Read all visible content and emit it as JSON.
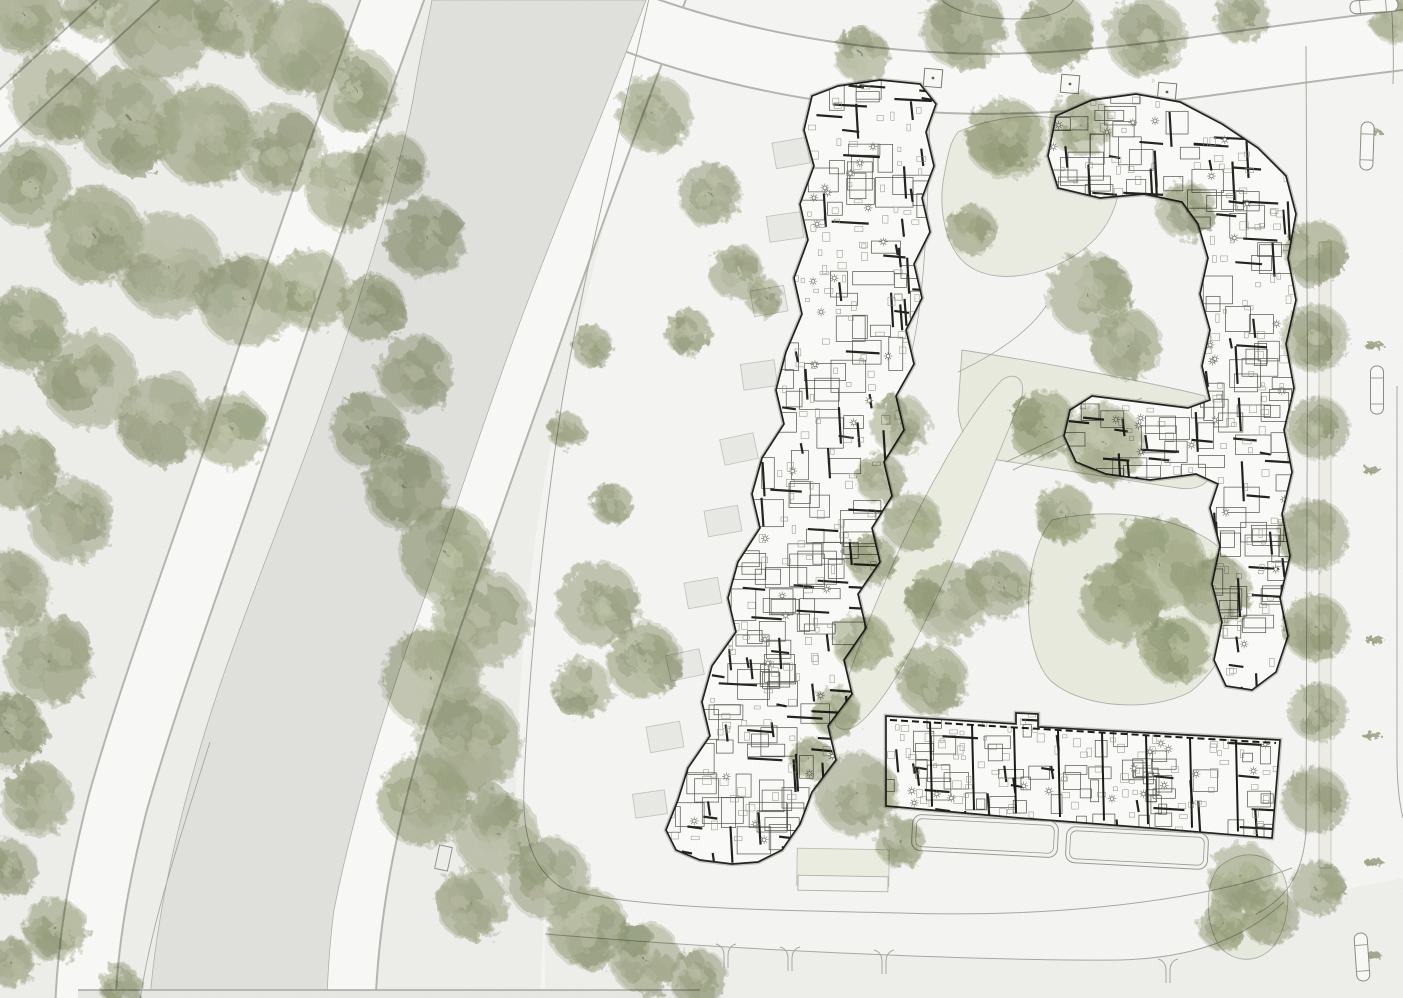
{
  "meta": {
    "title": "Residential quarter site plan with canal and woodland",
    "width": 1403,
    "height": 998,
    "drawing_type": "architectural site plan",
    "visible_text": ""
  },
  "palette": {
    "bg": "#f7f7f5",
    "park": "#f0f0ec",
    "canal": "#e2e3df",
    "band_edge": "#b6b6b0",
    "band_fill": "#fbfbf9",
    "line": "#a8a8a2",
    "line_dark": "#77776f",
    "lawn_stroke": "#b2b2aa",
    "building_fill": "#fdfdfb",
    "building_halo": "#97978f",
    "wall": "#1d1d1a",
    "room": "#4f4f49",
    "furniture": "#8f8f86",
    "terrace_fill": "#ebebe7",
    "terrace_stroke": "#c6c6c0",
    "sidewalk": "#f0efe8",
    "green_base": [
      "#aab08f",
      "#9ca580",
      "#b6bca0",
      "#a3a98a"
    ],
    "green_dark": "#8f9875",
    "green_light": "#c3c8ad",
    "bottom_strip": "#f1f1ee",
    "car_fill": "#fbfbf9",
    "car_stroke": "#8a8a84"
  },
  "ground": {
    "park_poly": "M0,0 L660,0 C625,150 585,295 552,440 C528,560 518,690 516,790 C515,845 525,872 545,890 L540,998 L0,998 Z",
    "canal_poly": "M432,0 L646,0 C602,118 560,214 520,322 C480,430 452,520 416,622 C380,724 352,820 334,910 C330,940 328,970 327,998 L150,998 C158,905 180,812 208,722 C240,620 286,512 322,408 C358,306 402,168 415,88 C420,56 428,22 432,0 Z",
    "bottom_strip_poly": "M545,934 C760,952 1000,961 1120,960 C1192,958 1242,940 1284,902 L1403,878 L1403,998 L545,998 Z",
    "bottom_edge_rect": {
      "x": 78,
      "y": 990,
      "w": 622,
      "h": 8
    }
  },
  "bands": [
    {
      "name": "corner-road-northwest",
      "d": "M-24,140 L154,-24",
      "w": 44
    },
    {
      "name": "towpath-west",
      "d": "M398,-16 C348,122 298,264 252,402 C206,540 152,682 118,802 C96,888 87,952 85,1012",
      "w": 62
    },
    {
      "name": "towpath-east",
      "d": "M664,-16 C612,122 566,246 522,374 C482,484 448,584 410,694 C374,802 353,902 349,1012",
      "w": 54
    },
    {
      "name": "north-loop-road",
      "d": "M516,-32 C620,28 762,72 930,82 C1082,92 1222,60 1420,38",
      "w": 62
    }
  ],
  "lawns": [
    {
      "name": "courtyard-green-north",
      "d": "M958,132 C1008,110 1076,110 1108,140 C1128,164 1122,210 1096,238 C1066,270 1006,288 972,268 C944,252 938,206 944,176 C948,154 950,142 958,132 Z",
      "fill": "#edeee4"
    },
    {
      "name": "courtyard-wedge",
      "d": "M962,350 C1040,362 1150,382 1205,396 L1212,468 C1212,484 1196,491 1178,488 L998,460 C972,455 960,436 958,410 Z",
      "fill": "#eaede0"
    },
    {
      "name": "courtyard-green-south",
      "d": "M1052,520 C1120,504 1200,520 1232,560 C1250,600 1230,662 1190,692 C1150,713 1080,708 1050,680 C1022,650 1020,560 1052,520 Z",
      "fill": "#eaede0"
    },
    {
      "name": "swale-garden",
      "d": "M836,716 C858,640 900,540 940,470 C960,432 986,396 1002,380 C1016,370 1027,381 1021,399 C996,460 956,560 916,640 C896,682 868,721 852,728 C840,732 832,726 836,716 Z",
      "fill": "#ecefe2"
    },
    {
      "name": "traffic-island-green",
      "d": "M1218,868 C1240,848 1268,852 1282,872 C1293,893 1288,928 1272,948 C1256,965 1230,962 1218,944 C1206,922 1204,888 1218,868 Z",
      "fill": "#e9ece0"
    }
  ],
  "lawn_panel": {
    "x": 797,
    "y": 849,
    "w": 92,
    "h": 37,
    "rot": 1,
    "fill": "#eef0e3",
    "stroke": "#bdbdb5"
  },
  "paths": [
    {
      "name": "site-boundary",
      "d": "M650,-6 C622,120 586,262 562,402 C544,520 530,652 524,782 C522,832 530,868 562,888 C624,908 760,910 900,913 C1050,918 1200,902 1292,868",
      "w": 1
    },
    {
      "name": "curb-south",
      "d": "M545,934 C760,952 1000,961 1120,960 C1192,958 1242,940 1284,902",
      "w": 1
    },
    {
      "name": "curve-northeast",
      "d": "M940,-2 C952,14 1000,23 1040,17 C1062,13 1072,5 1074,-2",
      "w": 1
    },
    {
      "name": "curb-east-road",
      "d": "M1306,46 C1308,300 1308,600 1306,832 C1303,872 1288,898 1256,914",
      "w": 1
    },
    {
      "name": "curb-far-right-top",
      "d": "M1391,-2 C1393,28 1394,56 1393,84",
      "w": 1
    },
    {
      "name": "curb-far-right",
      "d": "M1397,386 L1397,756 C1397,788 1400,806 1403,818",
      "w": 1
    },
    {
      "name": "bank-line-southwest",
      "d": "M210,742 C180,838 152,920 140,1000",
      "w": 0.9
    },
    {
      "name": "court-path-a",
      "d": "M906,372 C920,330 928,260 930,96",
      "w": 0.8
    },
    {
      "name": "court-path-b",
      "d": "M958,372 C1000,352 1030,330 1046,306",
      "w": 0.8
    },
    {
      "name": "court-path-c",
      "d": "M1215,476 C1243,486 1260,498 1270,514",
      "w": 0.8
    },
    {
      "name": "ramp-line-1",
      "d": "M1006,462 L1142,398",
      "w": 1
    },
    {
      "name": "ramp-line-2",
      "d": "M1013,470 L1148,404",
      "w": 1
    },
    {
      "name": "bottom-edge-line",
      "d": "M78,990 L700,990",
      "w": 1.4
    }
  ],
  "sidewalk_band": {
    "x": 1319,
    "y": 242,
    "w": 12,
    "h": 626
  },
  "curb_cuts": [
    [
      726,
      944
    ],
    [
      790,
      947
    ],
    [
      884,
      950
    ],
    [
      1168,
      959
    ]
  ],
  "planters": [
    [
      933,
      78
    ],
    [
      1070,
      84
    ],
    [
      1167,
      92
    ]
  ],
  "misc_rects": [
    {
      "name": "canal-jetty",
      "x": 437,
      "y": 846,
      "w": 13,
      "h": 24,
      "rot": 12,
      "fill": "none",
      "stroke": "#8a8a85"
    },
    {
      "name": "parking-pad",
      "x": 798,
      "y": 876,
      "w": 90,
      "h": 15,
      "rot": 1,
      "fill": "#f6f6f2",
      "stroke": "#b0b0aa"
    }
  ],
  "terraces_building_a": [
    {
      "x": 774,
      "y": 140,
      "w": 34,
      "h": 26,
      "rot": -10
    },
    {
      "x": 768,
      "y": 214,
      "w": 34,
      "h": 26,
      "rot": -8
    },
    {
      "x": 752,
      "y": 288,
      "w": 34,
      "h": 26,
      "rot": -10
    },
    {
      "x": 742,
      "y": 362,
      "w": 34,
      "h": 26,
      "rot": -8
    },
    {
      "x": 722,
      "y": 436,
      "w": 34,
      "h": 26,
      "rot": -12
    },
    {
      "x": 706,
      "y": 508,
      "w": 34,
      "h": 26,
      "rot": -10
    },
    {
      "x": 686,
      "y": 580,
      "w": 34,
      "h": 26,
      "rot": -10
    },
    {
      "x": 668,
      "y": 652,
      "w": 34,
      "h": 26,
      "rot": -12
    },
    {
      "x": 648,
      "y": 724,
      "w": 34,
      "h": 26,
      "rot": -10
    },
    {
      "x": 634,
      "y": 792,
      "w": 32,
      "h": 24,
      "rot": -8
    }
  ],
  "buildings": [
    {
      "id": "A",
      "name": "apartment-slab-central",
      "seed": 11,
      "rooms": 110,
      "walls": 84,
      "furn": 150,
      "sym": 30,
      "room_w": [
        12,
        42
      ],
      "room_h": [
        10,
        34
      ],
      "outline": [
        [
          812,
          96
        ],
        [
          838,
          86
        ],
        [
          880,
          80
        ],
        [
          920,
          84
        ],
        [
          936,
          104
        ],
        [
          926,
          132
        ],
        [
          934,
          166
        ],
        [
          922,
          198
        ],
        [
          930,
          232
        ],
        [
          914,
          264
        ],
        [
          922,
          298
        ],
        [
          906,
          330
        ],
        [
          914,
          364
        ],
        [
          896,
          396
        ],
        [
          904,
          430
        ],
        [
          884,
          462
        ],
        [
          892,
          496
        ],
        [
          872,
          528
        ],
        [
          880,
          562
        ],
        [
          858,
          594
        ],
        [
          866,
          628
        ],
        [
          844,
          660
        ],
        [
          852,
          694
        ],
        [
          828,
          726
        ],
        [
          836,
          760
        ],
        [
          812,
          792
        ],
        [
          800,
          824
        ],
        [
          782,
          850
        ],
        [
          758,
          862
        ],
        [
          732,
          864
        ],
        [
          700,
          860
        ],
        [
          676,
          850
        ],
        [
          666,
          830
        ],
        [
          678,
          800
        ],
        [
          688,
          768
        ],
        [
          710,
          736
        ],
        [
          702,
          702
        ],
        [
          712,
          666
        ],
        [
          736,
          632
        ],
        [
          728,
          598
        ],
        [
          738,
          562
        ],
        [
          760,
          528
        ],
        [
          752,
          494
        ],
        [
          762,
          458
        ],
        [
          784,
          424
        ],
        [
          776,
          390
        ],
        [
          786,
          352
        ],
        [
          802,
          314
        ],
        [
          794,
          278
        ],
        [
          808,
          240
        ],
        [
          800,
          204
        ],
        [
          814,
          166
        ],
        [
          804,
          130
        ]
      ]
    },
    {
      "id": "B",
      "name": "apartment-block-east",
      "seed": 29,
      "rooms": 88,
      "walls": 62,
      "furn": 112,
      "sym": 24,
      "room_w": [
        12,
        38
      ],
      "room_h": [
        10,
        30
      ],
      "outline": [
        [
          1056,
          116
        ],
        [
          1092,
          100
        ],
        [
          1136,
          94
        ],
        [
          1180,
          102
        ],
        [
          1222,
          124
        ],
        [
          1258,
          148
        ],
        [
          1286,
          176
        ],
        [
          1296,
          214
        ],
        [
          1288,
          258
        ],
        [
          1296,
          300
        ],
        [
          1286,
          344
        ],
        [
          1294,
          388
        ],
        [
          1284,
          430
        ],
        [
          1292,
          472
        ],
        [
          1282,
          514
        ],
        [
          1290,
          556
        ],
        [
          1280,
          598
        ],
        [
          1288,
          636
        ],
        [
          1276,
          672
        ],
        [
          1252,
          690
        ],
        [
          1226,
          686
        ],
        [
          1214,
          660
        ],
        [
          1222,
          622
        ],
        [
          1212,
          584
        ],
        [
          1220,
          546
        ],
        [
          1210,
          508
        ],
        [
          1218,
          484
        ],
        [
          1196,
          474
        ],
        [
          1150,
          480
        ],
        [
          1106,
          474
        ],
        [
          1076,
          462
        ],
        [
          1064,
          436
        ],
        [
          1070,
          410
        ],
        [
          1092,
          396
        ],
        [
          1140,
          402
        ],
        [
          1188,
          408
        ],
        [
          1210,
          400
        ],
        [
          1202,
          366
        ],
        [
          1210,
          330
        ],
        [
          1200,
          294
        ],
        [
          1208,
          258
        ],
        [
          1198,
          224
        ],
        [
          1182,
          202
        ],
        [
          1144,
          194
        ],
        [
          1100,
          198
        ],
        [
          1058,
          188
        ],
        [
          1048,
          156
        ]
      ]
    },
    {
      "id": "C",
      "name": "rowhouse-bar-south",
      "seed": 47,
      "rooms": 52,
      "walls": 28,
      "furn": 92,
      "sym": 16,
      "room_w": [
        8,
        26
      ],
      "room_h": [
        8,
        22
      ],
      "rowhouse": true,
      "walls_x": [
        930,
        972,
        1014,
        1058,
        1102,
        1146,
        1190,
        1236
      ],
      "dash_top": {
        "x1": 890,
        "y1": 720,
        "x2": 1276,
        "y2": 743
      },
      "outline": [
        [
          886,
          716
        ],
        [
          1016,
          724
        ],
        [
          1016,
          713
        ],
        [
          1038,
          714
        ],
        [
          1038,
          727
        ],
        [
          1280,
          740
        ],
        [
          1272,
          838
        ],
        [
          1150,
          828
        ],
        [
          1020,
          818
        ],
        [
          886,
          806
        ]
      ]
    }
  ],
  "terrace_bands_building_c": [
    {
      "x": 912,
      "y": 818,
      "w": 146,
      "h": 36,
      "rot": 3
    },
    {
      "x": 1066,
      "y": 830,
      "w": 142,
      "h": 36,
      "rot": 3
    }
  ],
  "trees": [
    [
      25,
      15,
      38
    ],
    [
      95,
      8,
      30
    ],
    [
      160,
      30,
      48
    ],
    [
      235,
      15,
      40
    ],
    [
      300,
      45,
      46
    ],
    [
      355,
      90,
      40
    ],
    [
      55,
      95,
      44
    ],
    [
      130,
      120,
      50
    ],
    [
      205,
      135,
      48
    ],
    [
      280,
      150,
      42
    ],
    [
      345,
      190,
      38
    ],
    [
      30,
      185,
      40
    ],
    [
      95,
      235,
      46
    ],
    [
      170,
      265,
      50
    ],
    [
      245,
      300,
      44
    ],
    [
      310,
      290,
      38
    ],
    [
      25,
      330,
      40
    ],
    [
      90,
      380,
      46
    ],
    [
      160,
      420,
      42
    ],
    [
      230,
      430,
      36
    ],
    [
      20,
      470,
      38
    ],
    [
      70,
      520,
      40
    ],
    [
      10,
      590,
      38
    ],
    [
      48,
      660,
      42
    ],
    [
      8,
      730,
      36
    ],
    [
      38,
      800,
      34
    ],
    [
      8,
      868,
      28
    ],
    [
      55,
      930,
      30
    ],
    [
      10,
      962,
      24
    ],
    [
      120,
      985,
      20
    ],
    [
      392,
      168,
      34
    ],
    [
      425,
      238,
      38
    ],
    [
      372,
      308,
      32
    ],
    [
      415,
      372,
      36
    ],
    [
      368,
      430,
      36
    ],
    [
      406,
      488,
      40
    ],
    [
      446,
      552,
      44
    ],
    [
      482,
      618,
      46
    ],
    [
      432,
      678,
      48
    ],
    [
      468,
      742,
      50
    ],
    [
      424,
      800,
      44
    ],
    [
      496,
      834,
      40
    ],
    [
      548,
      878,
      40
    ],
    [
      472,
      904,
      34
    ],
    [
      588,
      928,
      38
    ],
    [
      645,
      958,
      34
    ],
    [
      698,
      978,
      28
    ],
    [
      598,
      604,
      40
    ],
    [
      644,
      660,
      36
    ],
    [
      582,
      688,
      28
    ],
    [
      592,
      346,
      20
    ],
    [
      566,
      430,
      18
    ],
    [
      612,
      504,
      20
    ],
    [
      654,
      114,
      36
    ],
    [
      710,
      194,
      30
    ],
    [
      736,
      272,
      26
    ],
    [
      688,
      332,
      22
    ],
    [
      764,
      297,
      18
    ],
    [
      862,
      56,
      26
    ],
    [
      963,
      27,
      40
    ],
    [
      1056,
      31,
      36
    ],
    [
      1146,
      37,
      38
    ],
    [
      1242,
      16,
      26
    ],
    [
      1396,
      16,
      26
    ],
    [
      1006,
      138,
      38
    ],
    [
      1080,
      124,
      30
    ],
    [
      972,
      230,
      24
    ],
    [
      1090,
      294,
      40
    ],
    [
      1126,
      344,
      34
    ],
    [
      1186,
      210,
      28
    ],
    [
      1044,
      424,
      32
    ],
    [
      1104,
      444,
      38
    ],
    [
      1064,
      514,
      28
    ],
    [
      1160,
      564,
      44
    ],
    [
      1216,
      590,
      34
    ],
    [
      1120,
      604,
      38
    ],
    [
      1176,
      650,
      32
    ],
    [
      900,
      424,
      28
    ],
    [
      880,
      478,
      24
    ],
    [
      912,
      522,
      28
    ],
    [
      872,
      560,
      24
    ],
    [
      948,
      602,
      38
    ],
    [
      1000,
      584,
      32
    ],
    [
      862,
      642,
      28
    ],
    [
      932,
      680,
      34
    ],
    [
      836,
      712,
      24
    ],
    [
      856,
      794,
      40
    ],
    [
      900,
      842,
      24
    ],
    [
      810,
      758,
      20
    ],
    [
      1242,
      876,
      32
    ],
    [
      1270,
      916,
      28
    ],
    [
      1224,
      926,
      24
    ]
  ],
  "street_trees": [
    [
      1316,
      252,
      30
    ],
    [
      1315,
      338,
      32
    ],
    [
      1318,
      428,
      30
    ],
    [
      1313,
      535,
      34
    ],
    [
      1316,
      628,
      32
    ],
    [
      1318,
      712,
      28
    ],
    [
      1315,
      800,
      32
    ],
    [
      1318,
      888,
      26
    ]
  ],
  "shrubs": [
    [
      1372,
      132
    ],
    [
      1374,
      345
    ],
    [
      1372,
      470
    ],
    [
      1375,
      640
    ],
    [
      1372,
      735
    ],
    [
      1374,
      862
    ],
    [
      1371,
      955
    ]
  ],
  "cars": [
    {
      "x": 1367,
      "y": 146,
      "rot": 2
    },
    {
      "x": 1377,
      "y": 390,
      "rot": 0
    },
    {
      "x": 1362,
      "y": 957,
      "rot": -4
    },
    {
      "x": 1374,
      "y": 6,
      "rot": 86
    }
  ]
}
